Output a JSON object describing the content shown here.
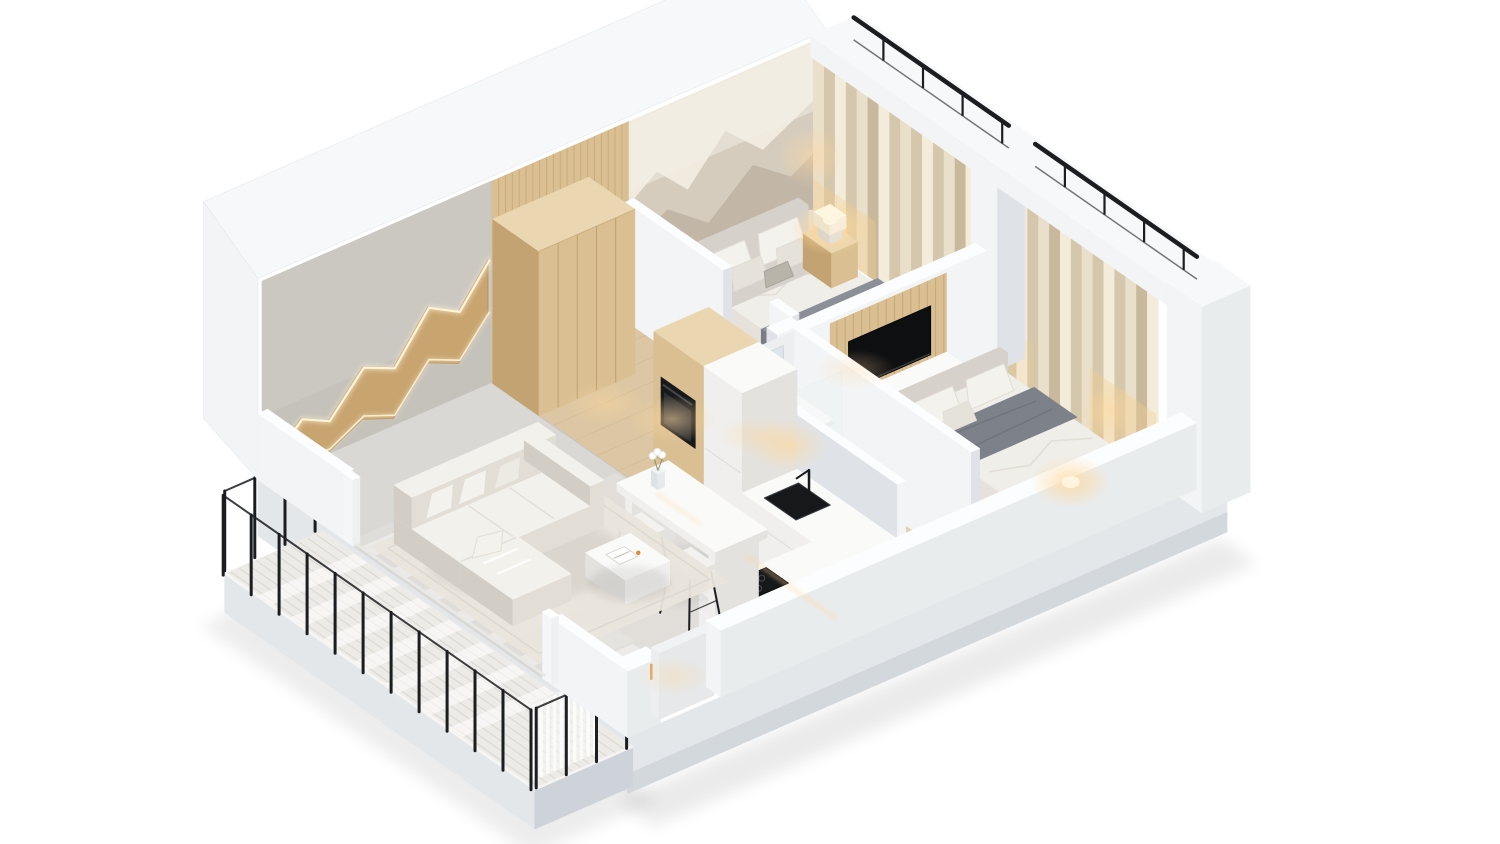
{
  "scene": {
    "type": "isometric-3d-floor-plan-render",
    "background": "#ffffff",
    "projection": "dimetric-cutaway",
    "text_content": "none"
  },
  "palette": {
    "bg": "#ffffff",
    "wallTop": "#f7f8fa",
    "wallOuter": "#e9eced",
    "wallInner": "#f3f4f5",
    "wallCut": "#fcfdfe",
    "wallShade": "#dfe3e7",
    "slabSide": "#e4e7ea",
    "slabDark": "#ced3d9",
    "concrete": "#cbc8c2",
    "concreteDark": "#b9b6b0",
    "mural1": "#d2c9ba",
    "mural2": "#c0b5a4",
    "mural3": "#e8e2d5",
    "muralSky": "#f0eadf",
    "artWood": "#c8a46f",
    "artWoodDark": "#b28e59",
    "led": "#fff3d8",
    "slatBlack": "#26282b",
    "wood": "#d9bf92",
    "woodTop": "#ead7b2",
    "woodDark": "#c3a371",
    "woodLine": "#b99a67",
    "floorWood": "#dcc6a3",
    "floorWoodLine": "#cbb387",
    "floorLiving": "#dad8d4",
    "floorLivingLight": "#e8e6e2",
    "bathFloor": "#e3d2b2",
    "rugLiving": "#eae6dd",
    "rugBed": "#d9d4c7",
    "rugLine": "#cfc9ba",
    "sofa": "#f3f1ec",
    "sofaShade": "#e2ded6",
    "sofaDark": "#d3cec5",
    "pillow": "#f4f2ec",
    "pillowGray": "#e5e2da",
    "pillowDark": "#b8b4aa",
    "white": "#fafaf9",
    "counterFront": "#f0efed",
    "counterShade": "#e3e2df",
    "black": "#17181a",
    "ovenGlass": "#2b2e33",
    "tvBlack": "#0e0f11",
    "steel": "#43474d",
    "railBlack": "#1b1d20",
    "radiator": "#2a2d32",
    "radiatorFin": "#565b62",
    "duvet": "#f0eee9",
    "duvetShade": "#ded9d1",
    "mattressSide": "#e6e2db",
    "headboard": "#d6d2cb",
    "blanket1": "#8c8f97",
    "blanket1Side": "#7a7d85",
    "blanket2": "#7d818a",
    "blanket2Side": "#6d7179",
    "curtain1": "#eadfca",
    "curtain2": "#d5c7ab",
    "curtain3": "#f3ecdb",
    "curtain4": "#c8b99d",
    "curtainWarm": "#f7cd8d",
    "marble": "#edeef0",
    "marbleVein": "#b4b8bf",
    "mirror": "#dce6ec",
    "glass": "#eaf1f4",
    "glowWarm": "#ffd89c",
    "glowCore": "#fff6e0",
    "deck": "#edebe7",
    "deckLine": "#d9d6d1",
    "deckBright": "#f6f5f3",
    "doorAccent": "#dfa45e",
    "shadow": "#5b6167"
  },
  "rooms": [
    {
      "id": "living-dining",
      "furniture": [
        "corner-sofa",
        "coffee-table",
        "area-rug",
        "dining-table",
        "bar-stools",
        "flower-vase",
        "feature-wall-wood-art",
        "led-strip",
        "black-slat-screen",
        "balcony-sliding-door"
      ]
    },
    {
      "id": "kitchen",
      "furniture": [
        "tall-oven-cabinet",
        "built-in-oven",
        "tall-fridge-cabinet",
        "white-counter",
        "black-sink",
        "faucet",
        "induction-cooktop"
      ]
    },
    {
      "id": "hallway",
      "furniture": [
        "wood-wardrobe",
        "ceiling-spotlights",
        "entry-door",
        "door-mat"
      ]
    },
    {
      "id": "bathroom",
      "furniture": [
        "marble-shower-wall",
        "glass-screen",
        "wood-vanity",
        "washbasin",
        "mirror"
      ]
    },
    {
      "id": "bedroom-1",
      "furniture": [
        "double-bed",
        "gray-throw-blanket",
        "pillows",
        "wood-nightstand",
        "white-nightstand",
        "table-lamp",
        "mountain-mural-wall",
        "sheer-curtains",
        "area-rug",
        "tv-console",
        "tv"
      ]
    },
    {
      "id": "bedroom-2",
      "furniture": [
        "double-bed",
        "gray-throw-blanket",
        "pillows",
        "wood-slat-tv-panel",
        "white-dresser",
        "tv",
        "floor-radiator",
        "sheer-curtains",
        "area-rug",
        "wall-lamp"
      ]
    },
    {
      "id": "balcony",
      "furniture": [
        "wood-deck",
        "black-railing",
        "white-privacy-screen"
      ]
    }
  ]
}
